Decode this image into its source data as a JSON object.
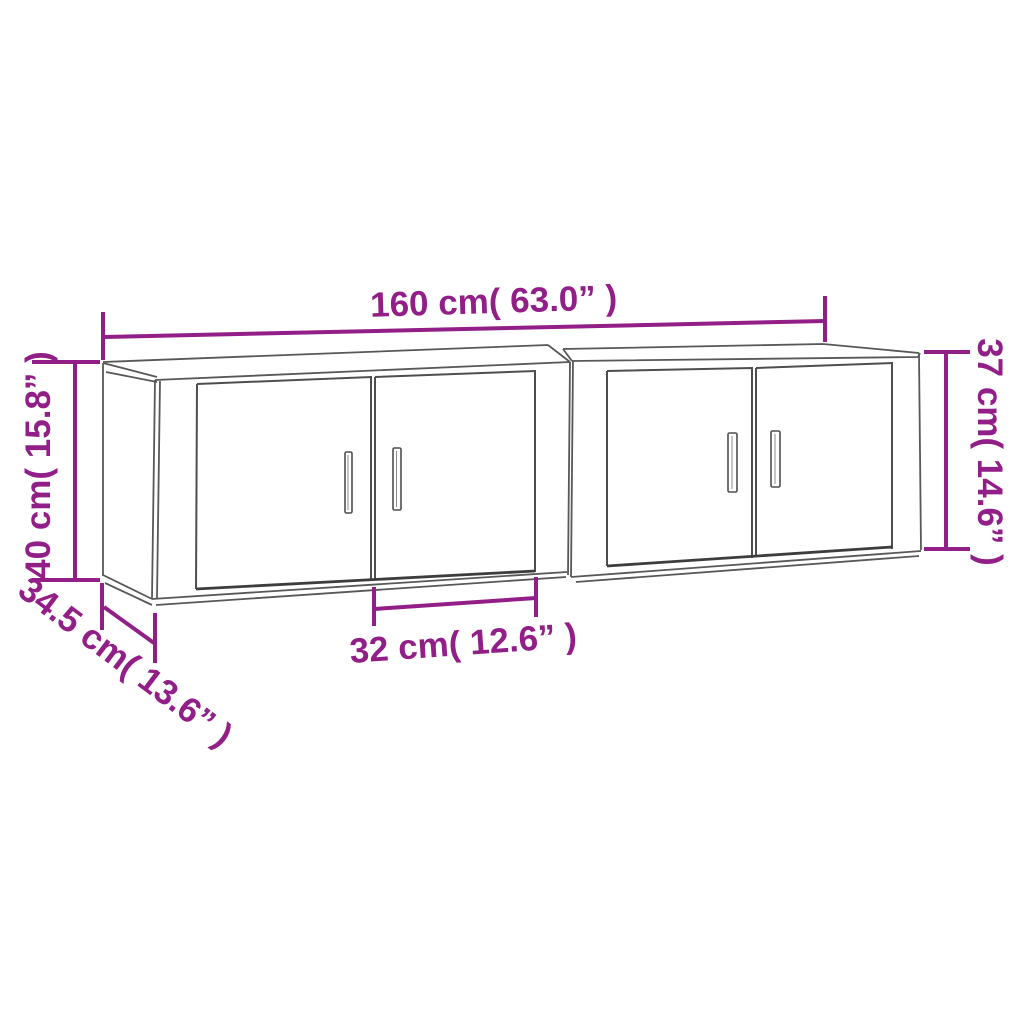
{
  "diagram": {
    "title": "Wall-mounted TV cabinets dimension drawing",
    "colors": {
      "dimension_accent": "#921E87",
      "outline_gray": "#555555",
      "background": "#FFFFFF"
    },
    "dimensions": {
      "width_total": "160 cm( 63.0” )",
      "height_left": "40 cm( 15.8” )",
      "height_right": "37 cm( 14.6” )",
      "depth": "34.5 cm( 13.6” )",
      "door_width": "32 cm( 12.6” )"
    }
  }
}
